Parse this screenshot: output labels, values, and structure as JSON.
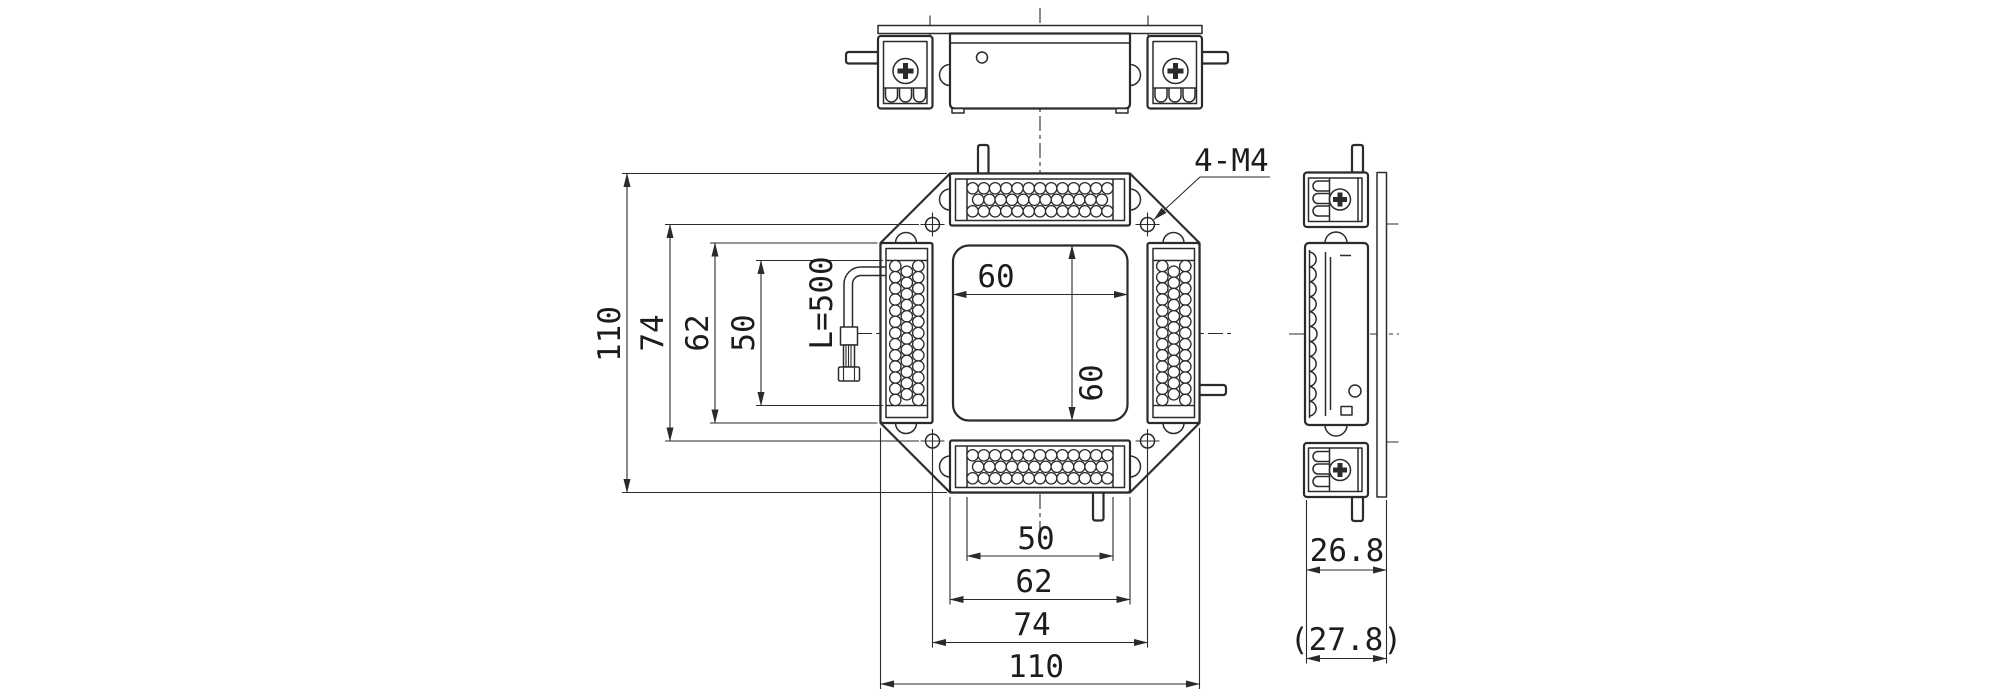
{
  "labels": {
    "thread_callout": "4-M4",
    "cable_length": "L=500"
  },
  "dimensions": {
    "left": [
      "110",
      "74",
      "62",
      "50"
    ],
    "bottom": [
      "50",
      "62",
      "74",
      "110"
    ],
    "window_width": "60",
    "window_height": "60",
    "side_depth": "26.8",
    "side_depth_overall": "(27.8)"
  },
  "led_pattern": {
    "modules": 4,
    "lines_per_module": 3,
    "dots_per_line": 13,
    "dot_diameter_px": 11.4,
    "side_scallops": 11
  },
  "colors": {
    "line": "#2b2b2b",
    "background": "#ffffff",
    "text": "#1c1c1c"
  }
}
